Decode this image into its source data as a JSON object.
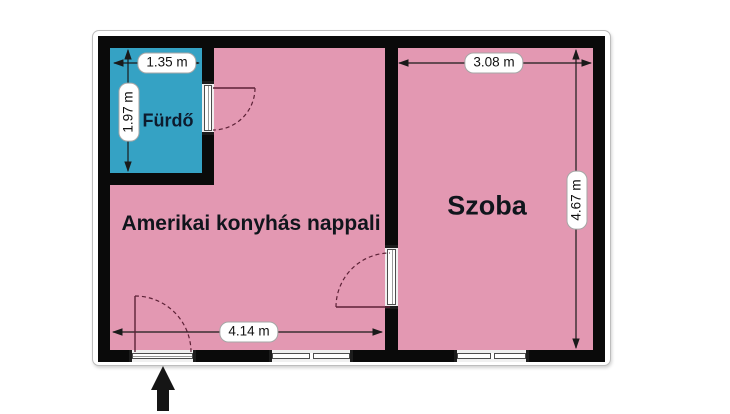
{
  "rooms": {
    "bathroom": {
      "label": "Fürdő",
      "color": "#35a2c4"
    },
    "living": {
      "label": "Amerikai konyhás nappali",
      "color": "#e398b2"
    },
    "bedroom": {
      "label": "Szoba",
      "color": "#e398b2"
    }
  },
  "dimensions": {
    "bathroom_width": "1.35 m",
    "bathroom_height": "1.97 m",
    "bedroom_width": "3.08 m",
    "bedroom_height": "4.67 m",
    "living_width": "4.14 m"
  },
  "icons": {
    "entrance_arrow_icon": "up-arrow"
  },
  "colors": {
    "wall": "#0a0a0a",
    "pink": "#e398b2",
    "blue": "#35a2c4",
    "arc": "#5c2136"
  }
}
